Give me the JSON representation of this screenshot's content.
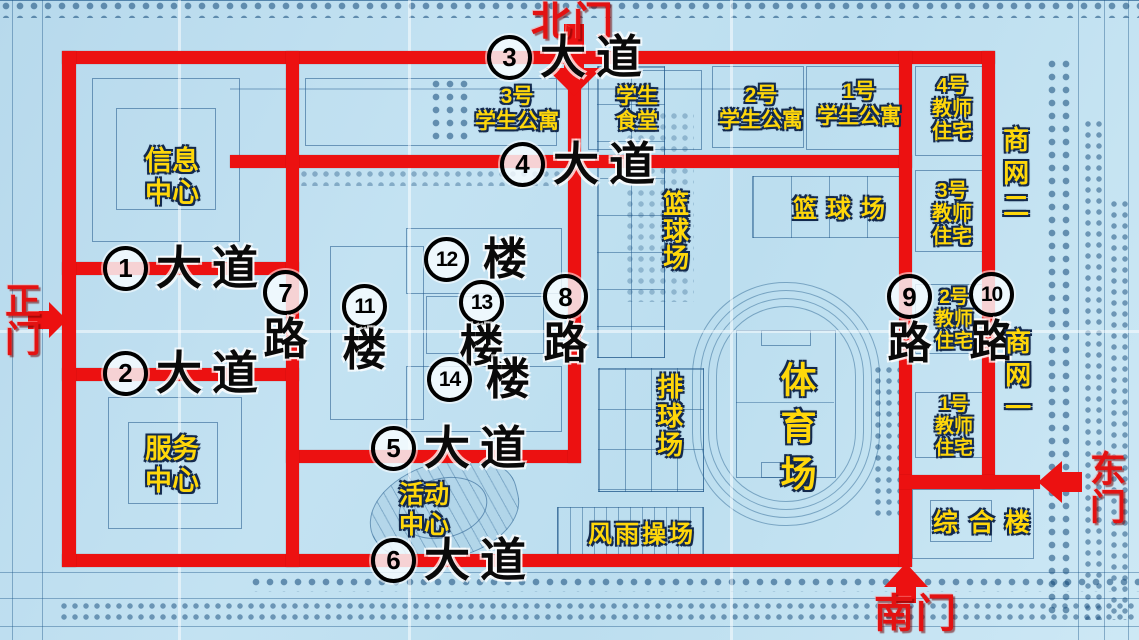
{
  "map_title": "campus-plan-map",
  "colors": {
    "road_red": "#ec1111",
    "gate_text_red": "#e31212",
    "facility_yellow": "#ffd70a",
    "road_label_black": "#0a0a0a",
    "blueprint_background": "#bfdff0",
    "blueprint_line": "#20588a"
  },
  "gates": {
    "north": {
      "label": "北门"
    },
    "main": {
      "label": "正门"
    },
    "east": {
      "label": "东门"
    },
    "south": {
      "label": "南门"
    }
  },
  "avenues": [
    {
      "num": "1",
      "suffix": "大道"
    },
    {
      "num": "2",
      "suffix": "大道"
    },
    {
      "num": "3",
      "suffix": "大道"
    },
    {
      "num": "4",
      "suffix": "大道"
    },
    {
      "num": "5",
      "suffix": "大道"
    },
    {
      "num": "6",
      "suffix": "大道"
    }
  ],
  "side_roads": [
    {
      "num": "7",
      "suffix": "路"
    },
    {
      "num": "8",
      "suffix": "路"
    },
    {
      "num": "9",
      "suffix": "路"
    },
    {
      "num": "10",
      "suffix": "路"
    }
  ],
  "buildings": [
    {
      "num": "11",
      "suffix": "楼"
    },
    {
      "num": "12",
      "suffix": "楼"
    },
    {
      "num": "13",
      "suffix": "楼"
    },
    {
      "num": "14",
      "suffix": "楼"
    }
  ],
  "facilities": {
    "info_center": [
      "信息",
      "中心"
    ],
    "service_center": [
      "服务",
      "中心"
    ],
    "activity_center": [
      "活动",
      "中心"
    ],
    "student_apartment_3": [
      "3号",
      "学生公寓"
    ],
    "student_canteen": [
      "学生",
      "食堂"
    ],
    "student_apartment_2": [
      "2号",
      "学生公寓"
    ],
    "student_apartment_1": [
      "1号",
      "学生公寓"
    ],
    "teacher_house_4": [
      "4号",
      "教师",
      "住宅"
    ],
    "teacher_house_3": [
      "3号",
      "教师",
      "住宅"
    ],
    "teacher_house_2": [
      "2号",
      "教师",
      "住宅"
    ],
    "teacher_house_1": [
      "1号",
      "教师",
      "住宅"
    ],
    "shop_street_2": "商网二",
    "shop_street_1": "商网一",
    "basketball_left": "篮球场",
    "basketball_right": "篮球场",
    "volleyball": "排球场",
    "stadium": "体育场",
    "rain_playground": "风雨操场",
    "complex_building": "综合楼"
  }
}
